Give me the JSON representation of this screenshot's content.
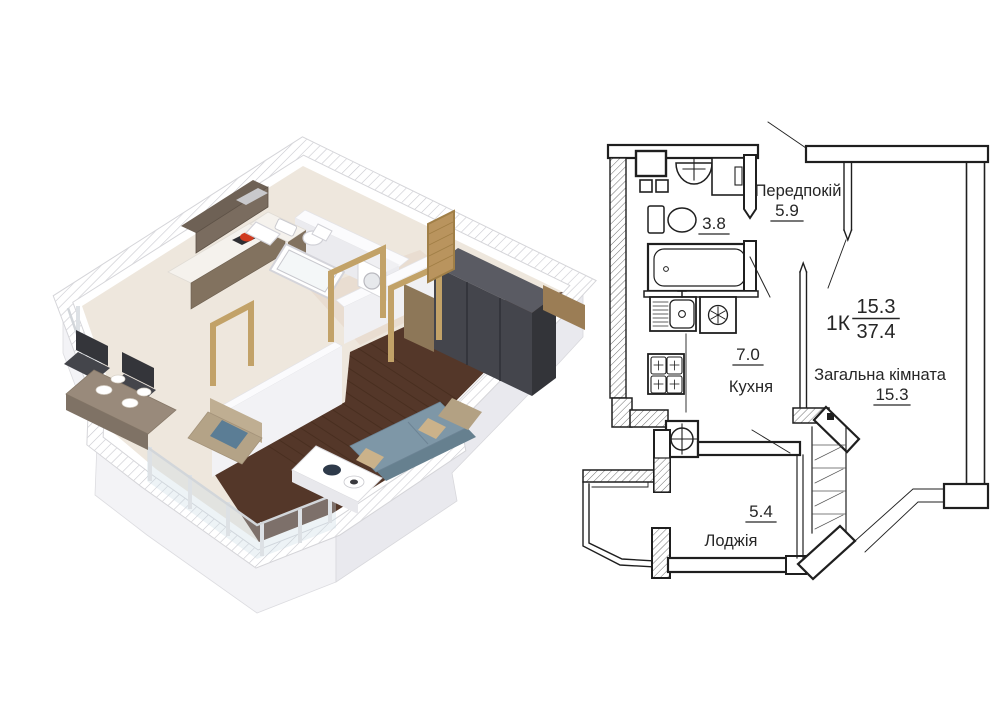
{
  "plan": {
    "title": "1-room apartment floor plan",
    "rooms": [
      {
        "key": "hallway",
        "label": "Передпокій",
        "area": "5.9"
      },
      {
        "key": "bathroom",
        "label": "",
        "area": "3.8"
      },
      {
        "key": "kitchen",
        "label": "Кухня",
        "area": "7.0"
      },
      {
        "key": "living_room",
        "label": "Загальна кімната",
        "area": "15.3"
      },
      {
        "key": "loggia",
        "label": "Лоджія",
        "area": "5.4"
      }
    ],
    "summary": {
      "type_label": "1К",
      "living_area": "15.3",
      "total_area": "37.4"
    },
    "colors": {
      "line": "#1f1f1f",
      "text": "#262626",
      "hatch": "#6e6e6e"
    }
  },
  "render_3d": {
    "kind": "isometric cutaway apartment render",
    "palette": {
      "wall": "#ffffff",
      "wall_side": "#ededf1",
      "wood_floor": "#543729",
      "tile_floor": "#eee7dd",
      "sofa": "#7e97a7",
      "wardrobe": "#44454c",
      "door_frame": "#c2a268",
      "cabinet": "#82725f",
      "accent_pan": "#cf3a1f"
    }
  }
}
